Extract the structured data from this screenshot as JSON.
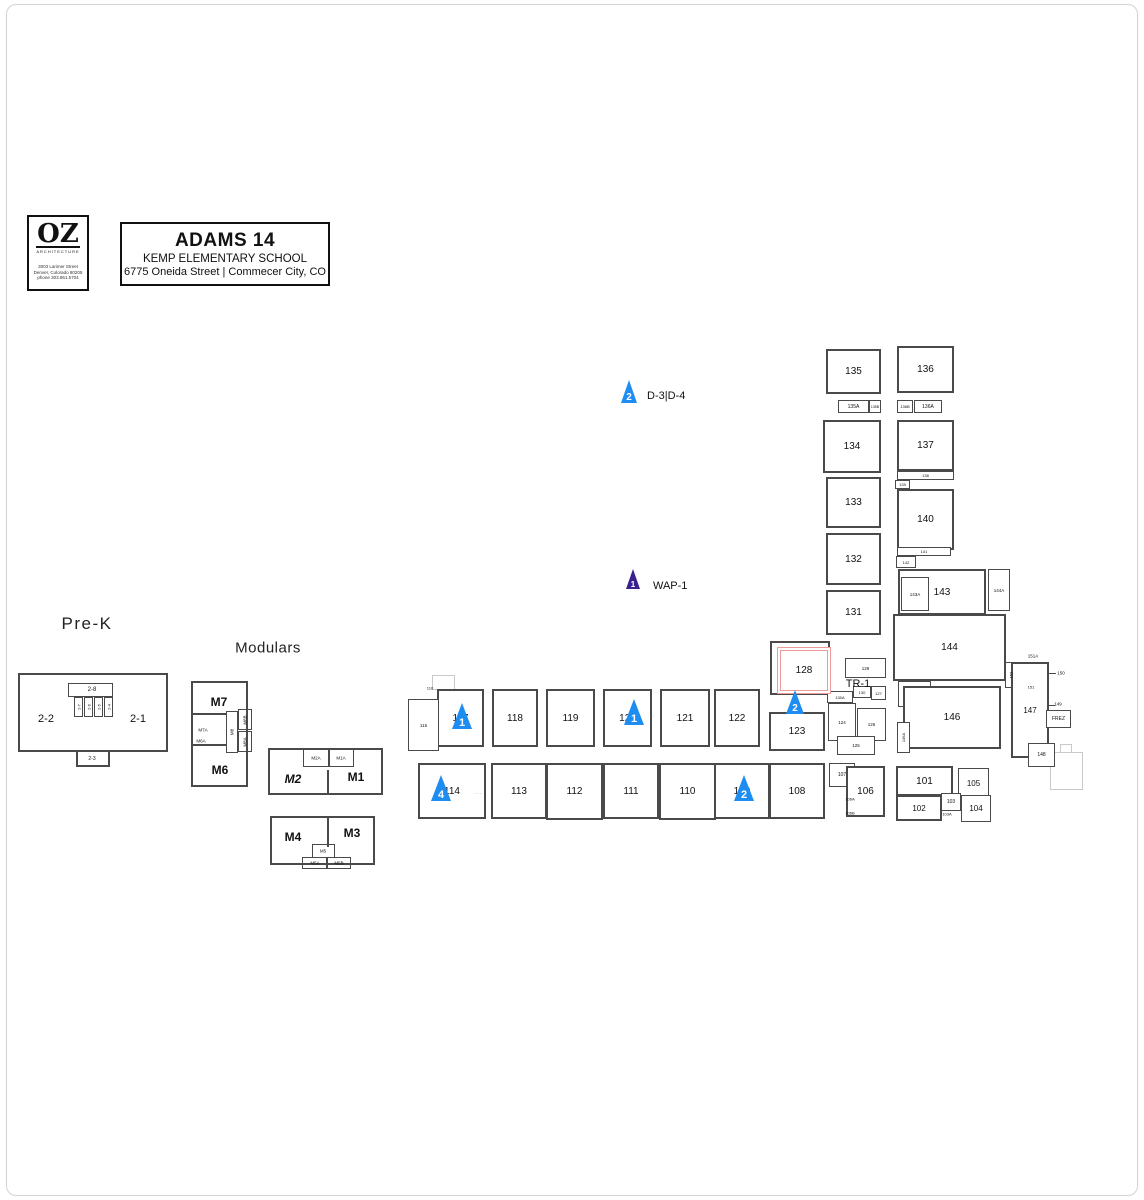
{
  "title_block": {
    "logo_text": "OZ",
    "logo_subtitle": "ARCHITECTURE",
    "logo_address_lines": [
      "3003 Larimer Street",
      "Denver, Colorado  80205",
      "phone  303.861.5704"
    ],
    "project_title": "ADAMS 14",
    "school_name": "KEMP ELEMENTARY SCHOOL",
    "street_address": "6775 Oneida Street  |  Commecer City, CO"
  },
  "areas": {
    "pre_k_label": "Pre-K",
    "modulars_label": "Modulars"
  },
  "colors": {
    "marker_blue": "#1e8df2",
    "marker_purple": "#3b1f8e",
    "highlight_red": "#f09b9b",
    "wall": "#4a4a4a",
    "faint": "#c9c9c9"
  },
  "highlight": {
    "label": "128",
    "x": 777,
    "y": 647,
    "w": 52,
    "h": 45
  },
  "markers": [
    {
      "n": "2",
      "label": "D-3|D-4",
      "x": 629,
      "yb": 403,
      "w": 17,
      "h": 23,
      "c": "blue",
      "lx": 647,
      "ly": 396
    },
    {
      "n": "1",
      "label": "WAP-1",
      "x": 633,
      "yb": 589,
      "w": 15,
      "h": 20,
      "c": "purple",
      "lx": 653,
      "ly": 586
    },
    {
      "n": "1",
      "label": "",
      "x": 462,
      "yb": 729,
      "w": 21,
      "h": 26,
      "c": "blue"
    },
    {
      "n": "1",
      "label": "",
      "x": 634,
      "yb": 725,
      "w": 21,
      "h": 26,
      "c": "blue"
    },
    {
      "n": "2",
      "label": "",
      "x": 795,
      "yb": 714,
      "w": 19,
      "h": 24,
      "c": "blue"
    },
    {
      "n": "4",
      "label": "",
      "x": 441,
      "yb": 801,
      "w": 21,
      "h": 26,
      "c": "blue"
    },
    {
      "n": "2",
      "label": "",
      "x": 744,
      "yb": 801,
      "w": 21,
      "h": 26,
      "c": "blue"
    }
  ],
  "rooms": [
    {
      "t": "135",
      "x": 826,
      "y": 349,
      "w": 55,
      "h": 45,
      "fs": 10
    },
    {
      "t": "136",
      "x": 897,
      "y": 346,
      "w": 57,
      "h": 47,
      "fs": 10
    },
    {
      "t": "135A",
      "x": 838,
      "y": 400,
      "w": 31,
      "h": 13,
      "fs": 5
    },
    {
      "t": "135B",
      "x": 869,
      "y": 400,
      "w": 12,
      "h": 13,
      "fs": 3.5
    },
    {
      "t": "136B",
      "x": 897,
      "y": 400,
      "w": 16,
      "h": 13,
      "fs": 4
    },
    {
      "t": "136A",
      "x": 914,
      "y": 400,
      "w": 28,
      "h": 13,
      "fs": 5
    },
    {
      "t": "134",
      "x": 823,
      "y": 420,
      "w": 58,
      "h": 53,
      "fs": 10
    },
    {
      "t": "137",
      "x": 897,
      "y": 420,
      "w": 57,
      "h": 51,
      "fs": 10
    },
    {
      "t": "138",
      "x": 897,
      "y": 471,
      "w": 57,
      "h": 9,
      "fs": 4
    },
    {
      "t": "139",
      "x": 895,
      "y": 480,
      "w": 15,
      "h": 9,
      "fs": 4
    },
    {
      "t": "133",
      "x": 826,
      "y": 477,
      "w": 55,
      "h": 51,
      "fs": 10
    },
    {
      "t": "140",
      "x": 897,
      "y": 489,
      "w": 57,
      "h": 61,
      "fs": 10
    },
    {
      "t": "132",
      "x": 826,
      "y": 533,
      "w": 55,
      "h": 52,
      "fs": 10
    },
    {
      "t": "141",
      "x": 897,
      "y": 547,
      "w": 54,
      "h": 9,
      "fs": 4
    },
    {
      "t": "142",
      "x": 896,
      "y": 556,
      "w": 20,
      "h": 12,
      "fs": 4
    },
    {
      "t": "131",
      "x": 826,
      "y": 590,
      "w": 55,
      "h": 45,
      "fs": 10
    },
    {
      "t": "143",
      "x": 898,
      "y": 569,
      "w": 88,
      "h": 46,
      "fs": 10
    },
    {
      "t": "143A",
      "x": 901,
      "y": 577,
      "w": 28,
      "h": 34,
      "fs": 4.5
    },
    {
      "t": "144A",
      "x": 988,
      "y": 569,
      "w": 22,
      "h": 42,
      "fs": 4.5
    },
    {
      "t": "144",
      "x": 893,
      "y": 614,
      "w": 113,
      "h": 67,
      "fs": 10
    },
    {
      "t": "145",
      "x": 898,
      "y": 681,
      "w": 33,
      "h": 26,
      "fs": 10
    },
    {
      "t": "146",
      "x": 903,
      "y": 686,
      "w": 98,
      "h": 63,
      "fs": 10
    },
    {
      "t": "146A",
      "x": 897,
      "y": 722,
      "w": 13,
      "h": 31,
      "fs": 4,
      "rot": 1
    },
    {
      "t": "147",
      "x": 1011,
      "y": 662,
      "w": 38,
      "h": 96,
      "fs": 8
    },
    {
      "t": "148",
      "x": 1028,
      "y": 743,
      "w": 27,
      "h": 24,
      "fs": 5
    },
    {
      "t": "FREZ",
      "x": 1046,
      "y": 710,
      "w": 25,
      "h": 18,
      "fs": 5
    },
    {
      "t": "",
      "x": 770,
      "y": 641,
      "w": 60,
      "h": 54
    },
    {
      "t": "129",
      "x": 845,
      "y": 658,
      "w": 41,
      "h": 20,
      "fs": 4.5
    },
    {
      "t": "130A",
      "x": 827,
      "y": 691,
      "w": 26,
      "h": 12,
      "fs": 4
    },
    {
      "t": "130",
      "x": 853,
      "y": 686,
      "w": 18,
      "h": 12,
      "fs": 4
    },
    {
      "t": "127",
      "x": 871,
      "y": 686,
      "w": 15,
      "h": 14,
      "fs": 4
    },
    {
      "t": "124",
      "x": 828,
      "y": 703,
      "w": 28,
      "h": 38,
      "fs": 4.5
    },
    {
      "t": "126",
      "x": 857,
      "y": 708,
      "w": 29,
      "h": 33,
      "fs": 4.5
    },
    {
      "t": "125",
      "x": 837,
      "y": 736,
      "w": 38,
      "h": 19,
      "fs": 4.5
    },
    {
      "t": "117",
      "x": 437,
      "y": 689,
      "w": 47,
      "h": 58,
      "fs": 10
    },
    {
      "t": "118",
      "x": 492,
      "y": 689,
      "w": 46,
      "h": 58,
      "fs": 10
    },
    {
      "t": "119",
      "x": 546,
      "y": 689,
      "w": 49,
      "h": 58,
      "fs": 10
    },
    {
      "t": "120",
      "x": 603,
      "y": 689,
      "w": 49,
      "h": 58,
      "fs": 10
    },
    {
      "t": "121",
      "x": 660,
      "y": 689,
      "w": 50,
      "h": 58,
      "fs": 10
    },
    {
      "t": "122",
      "x": 714,
      "y": 689,
      "w": 46,
      "h": 58,
      "fs": 10
    },
    {
      "t": "123",
      "x": 769,
      "y": 712,
      "w": 56,
      "h": 39,
      "fs": 10
    },
    {
      "t": "115",
      "x": 408,
      "y": 699,
      "w": 31,
      "h": 52,
      "fs": 4.5
    },
    {
      "t": "114",
      "x": 418,
      "y": 763,
      "w": 68,
      "h": 56,
      "fs": 10
    },
    {
      "t": "113",
      "x": 491,
      "y": 763,
      "w": 56,
      "h": 56,
      "fs": 10
    },
    {
      "t": "112",
      "x": 546,
      "y": 763,
      "w": 57,
      "h": 57,
      "fs": 10
    },
    {
      "t": "111",
      "x": 603,
      "y": 763,
      "w": 56,
      "h": 56,
      "fs": 10
    },
    {
      "t": "110",
      "x": 659,
      "y": 763,
      "w": 57,
      "h": 57,
      "fs": 10
    },
    {
      "t": "109",
      "x": 714,
      "y": 763,
      "w": 56,
      "h": 56,
      "fs": 10
    },
    {
      "t": "108",
      "x": 769,
      "y": 763,
      "w": 56,
      "h": 56,
      "fs": 10
    },
    {
      "t": "107",
      "x": 829,
      "y": 763,
      "w": 26,
      "h": 24,
      "fs": 5
    },
    {
      "t": "106",
      "x": 846,
      "y": 766,
      "w": 39,
      "h": 51,
      "fs": 10
    },
    {
      "t": "101",
      "x": 896,
      "y": 766,
      "w": 57,
      "h": 30,
      "fs": 10
    },
    {
      "t": "105",
      "x": 958,
      "y": 768,
      "w": 31,
      "h": 30,
      "fs": 8
    },
    {
      "t": "102",
      "x": 896,
      "y": 795,
      "w": 46,
      "h": 26,
      "fs": 8
    },
    {
      "t": "103",
      "x": 941,
      "y": 793,
      "w": 20,
      "h": 18,
      "fs": 5
    },
    {
      "t": "104",
      "x": 961,
      "y": 795,
      "w": 30,
      "h": 27,
      "fs": 8
    }
  ],
  "texts": [
    {
      "t": "2-8",
      "x": 92,
      "y": 690,
      "fs": 6
    },
    {
      "t": "2-2",
      "x": 46,
      "y": 719,
      "fs": 11
    },
    {
      "t": "2-1",
      "x": 138,
      "y": 719,
      "fs": 11
    },
    {
      "t": "2-3",
      "x": 92,
      "y": 759,
      "fs": 5
    },
    {
      "t": "2-7",
      "x": 79,
      "y": 707,
      "fs": 4,
      "rot": 1
    },
    {
      "t": "2-6",
      "x": 89,
      "y": 707,
      "fs": 4,
      "rot": 1
    },
    {
      "t": "2-5",
      "x": 99,
      "y": 707,
      "fs": 4,
      "rot": 1
    },
    {
      "t": "2-4",
      "x": 109,
      "y": 707,
      "fs": 4,
      "rot": 1
    },
    {
      "t": "M7",
      "x": 219,
      "y": 702,
      "fs": 12,
      "bold": 1
    },
    {
      "t": "M6",
      "x": 220,
      "y": 770,
      "fs": 12,
      "bold": 1
    },
    {
      "t": "M7A",
      "x": 203,
      "y": 730,
      "fs": 4.5
    },
    {
      "t": "M6A",
      "x": 201,
      "y": 741,
      "fs": 4.5
    },
    {
      "t": "M8",
      "x": 232,
      "y": 732,
      "fs": 4.5,
      "rot": 1
    },
    {
      "t": "M8B",
      "x": 245,
      "y": 720,
      "fs": 4.5,
      "rot": 1
    },
    {
      "t": "M8A",
      "x": 245,
      "y": 742,
      "fs": 4.5,
      "rot": 1
    },
    {
      "t": "M2",
      "x": 293,
      "y": 779,
      "fs": 12,
      "bold": 1,
      "it": 1
    },
    {
      "t": "M1",
      "x": 356,
      "y": 777,
      "fs": 12,
      "bold": 1
    },
    {
      "t": "M2A",
      "x": 316,
      "y": 758,
      "fs": 4.5
    },
    {
      "t": "M1A",
      "x": 341,
      "y": 758,
      "fs": 4.5
    },
    {
      "t": "M4",
      "x": 293,
      "y": 837,
      "fs": 12,
      "bold": 1
    },
    {
      "t": "M3",
      "x": 352,
      "y": 833,
      "fs": 12,
      "bold": 1
    },
    {
      "t": "M5",
      "x": 323,
      "y": 851,
      "fs": 4.5
    },
    {
      "t": "M5A",
      "x": 315,
      "y": 863,
      "fs": 4.5
    },
    {
      "t": "M5B",
      "x": 339,
      "y": 863,
      "fs": 4.5
    },
    {
      "t": "TR-1",
      "x": 858,
      "y": 684,
      "fs": 11
    },
    {
      "t": "151A",
      "x": 1033,
      "y": 656,
      "fs": 4.5
    },
    {
      "t": "152",
      "x": 1011,
      "y": 675,
      "fs": 4,
      "rot": 1
    },
    {
      "t": "150",
      "x": 1061,
      "y": 673,
      "fs": 4.5
    },
    {
      "t": "151",
      "x": 1031,
      "y": 687,
      "fs": 4
    },
    {
      "t": "149",
      "x": 1058,
      "y": 704,
      "fs": 4.5
    },
    {
      "t": "106A",
      "x": 850,
      "y": 799,
      "fs": 4
    },
    {
      "t": "106B",
      "x": 850,
      "y": 813,
      "fs": 4
    },
    {
      "t": "116",
      "x": 430,
      "y": 688,
      "fs": 4
    },
    {
      "t": "103A",
      "x": 947,
      "y": 814,
      "fs": 4
    },
    {
      "t": "- - -",
      "x": 478,
      "y": 793,
      "fs": 4,
      "c": "#777"
    },
    {
      "t": "- -",
      "x": 652,
      "y": 716,
      "fs": 4,
      "c": "#777"
    }
  ],
  "shapes": [
    {
      "name": "prek-outline",
      "x": 18,
      "y": 673,
      "w": 150,
      "h": 79,
      "bw": 2
    },
    {
      "name": "prek-bump",
      "x": 76,
      "y": 750,
      "w": 34,
      "h": 17,
      "bw": 2
    },
    {
      "name": "prek-room-28-box",
      "x": 68,
      "y": 683,
      "w": 45,
      "h": 14,
      "bw": 1
    },
    {
      "name": "prek-stall",
      "x": 74,
      "y": 697,
      "w": 9,
      "h": 20,
      "bw": 1
    },
    {
      "name": "prek-stall",
      "x": 84,
      "y": 697,
      "w": 9,
      "h": 20,
      "bw": 1
    },
    {
      "name": "prek-stall",
      "x": 94,
      "y": 697,
      "w": 9,
      "h": 20,
      "bw": 1
    },
    {
      "name": "prek-stall",
      "x": 104,
      "y": 697,
      "w": 9,
      "h": 20,
      "bw": 1
    },
    {
      "name": "modular-left-outline",
      "x": 191,
      "y": 681,
      "w": 57,
      "h": 106,
      "bw": 2
    },
    {
      "name": "modular-wall",
      "x": 191,
      "y": 713,
      "w": 36,
      "h": 2,
      "fill": 1
    },
    {
      "name": "modular-wall",
      "x": 191,
      "y": 744,
      "w": 36,
      "h": 2,
      "fill": 1
    },
    {
      "name": "modular-m8-box",
      "x": 226,
      "y": 711,
      "w": 12,
      "h": 42,
      "bw": 1
    },
    {
      "name": "modular-m8b-box",
      "x": 238,
      "y": 709,
      "w": 14,
      "h": 21,
      "bw": 1
    },
    {
      "name": "modular-m8a-box",
      "x": 238,
      "y": 731,
      "w": 14,
      "h": 21,
      "bw": 1
    },
    {
      "name": "modular-1-outline",
      "x": 268,
      "y": 748,
      "w": 115,
      "h": 47,
      "bw": 2
    },
    {
      "name": "modular-wall",
      "x": 327,
      "y": 770,
      "w": 2,
      "h": 25,
      "fill": 1
    },
    {
      "name": "modular-m2a-box",
      "x": 303,
      "y": 749,
      "w": 26,
      "h": 18,
      "bw": 1
    },
    {
      "name": "modular-m1a-box",
      "x": 329,
      "y": 749,
      "w": 25,
      "h": 18,
      "bw": 1
    },
    {
      "name": "modular-2-outline",
      "x": 270,
      "y": 816,
      "w": 105,
      "h": 49,
      "bw": 2
    },
    {
      "name": "modular-wall",
      "x": 327,
      "y": 817,
      "w": 2,
      "h": 30,
      "fill": 1
    },
    {
      "name": "modular-m5-box",
      "x": 312,
      "y": 844,
      "w": 23,
      "h": 14,
      "bw": 1
    },
    {
      "name": "modular-m5a-box",
      "x": 302,
      "y": 857,
      "w": 25,
      "h": 12,
      "bw": 1
    },
    {
      "name": "modular-m5b-box",
      "x": 327,
      "y": 857,
      "w": 24,
      "h": 12,
      "bw": 1
    },
    {
      "name": "entry-vestibule",
      "x": 432,
      "y": 675,
      "w": 23,
      "h": 15,
      "bw": 1,
      "c": "faint"
    },
    {
      "name": "future-building-outline",
      "x": 1050,
      "y": 752,
      "w": 33,
      "h": 38,
      "bw": 1,
      "c": "faint"
    },
    {
      "name": "future-building-bump",
      "x": 1060,
      "y": 744,
      "w": 12,
      "h": 9,
      "bw": 1,
      "c": "faint"
    },
    {
      "name": "room-152-box",
      "x": 1005,
      "y": 662,
      "w": 14,
      "h": 26,
      "bw": 1
    },
    {
      "name": "room-150-box",
      "x": 1020,
      "y": 662,
      "w": 25,
      "h": 25,
      "bw": 1
    },
    {
      "name": "leader-150",
      "x": 1040,
      "y": 673,
      "w": 16,
      "h": 1,
      "fill": 1
    },
    {
      "name": "leader-149",
      "x": 1046,
      "y": 705,
      "w": 9,
      "h": 1,
      "fill": 1
    }
  ]
}
